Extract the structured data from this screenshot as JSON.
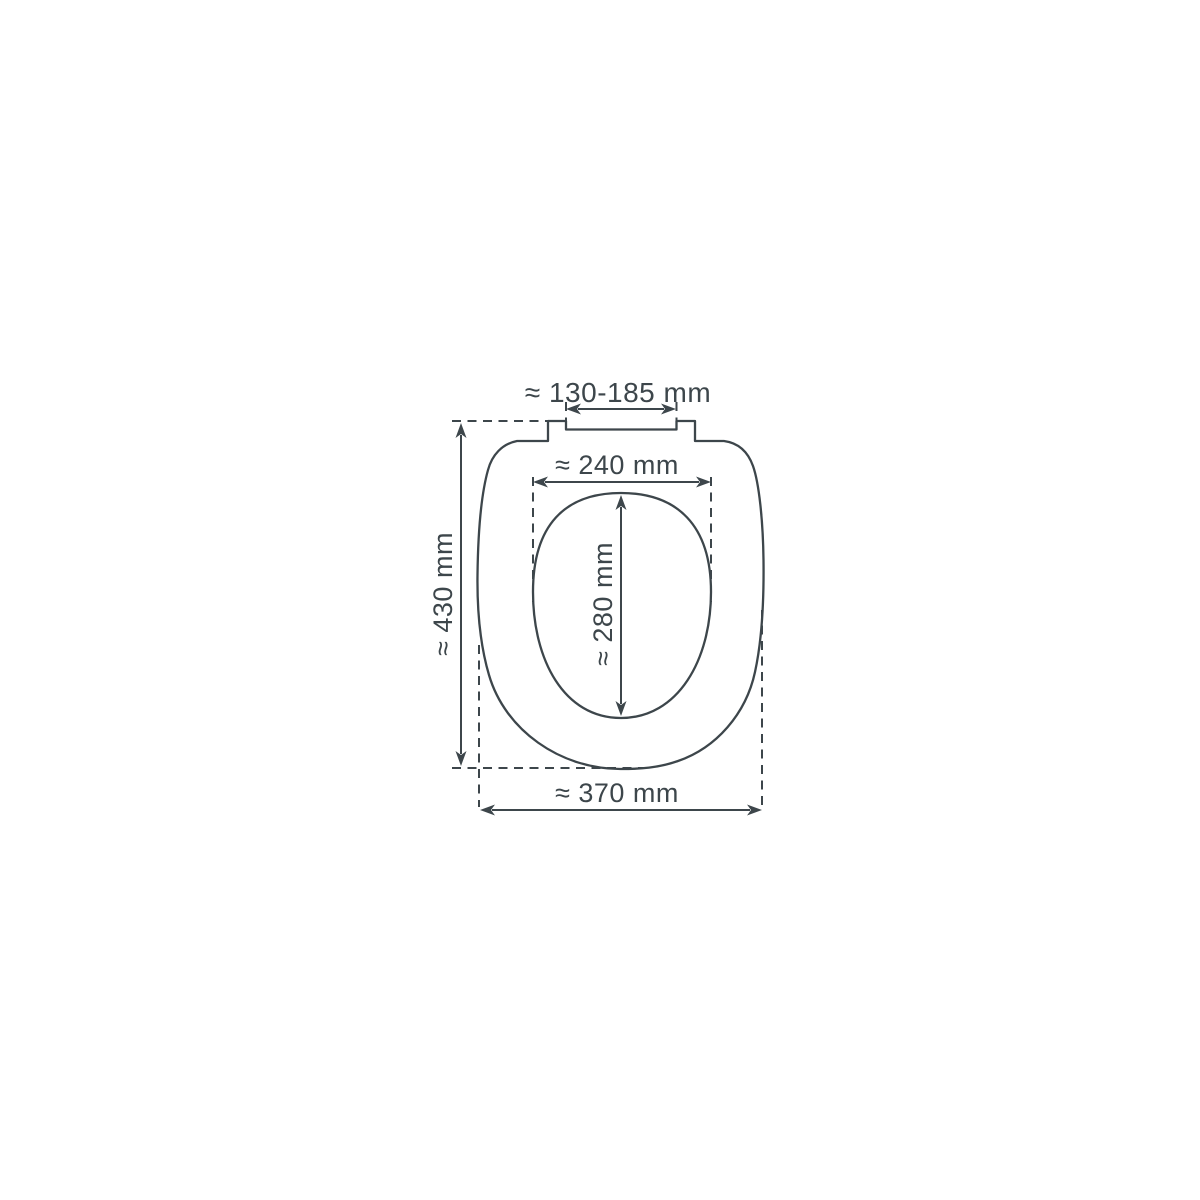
{
  "diagram": {
    "type": "technical-dimension-drawing",
    "subject": "toilet seat top view with measurements",
    "background_color": "#ffffff",
    "line_color": "#3d464b",
    "labels": {
      "hinge_width": "≈ 130-185 mm",
      "inner_width": "≈ 240 mm",
      "inner_length": "≈ 280 mm",
      "outer_length": "≈ 430 mm",
      "outer_width": "≈ 370 mm"
    }
  }
}
